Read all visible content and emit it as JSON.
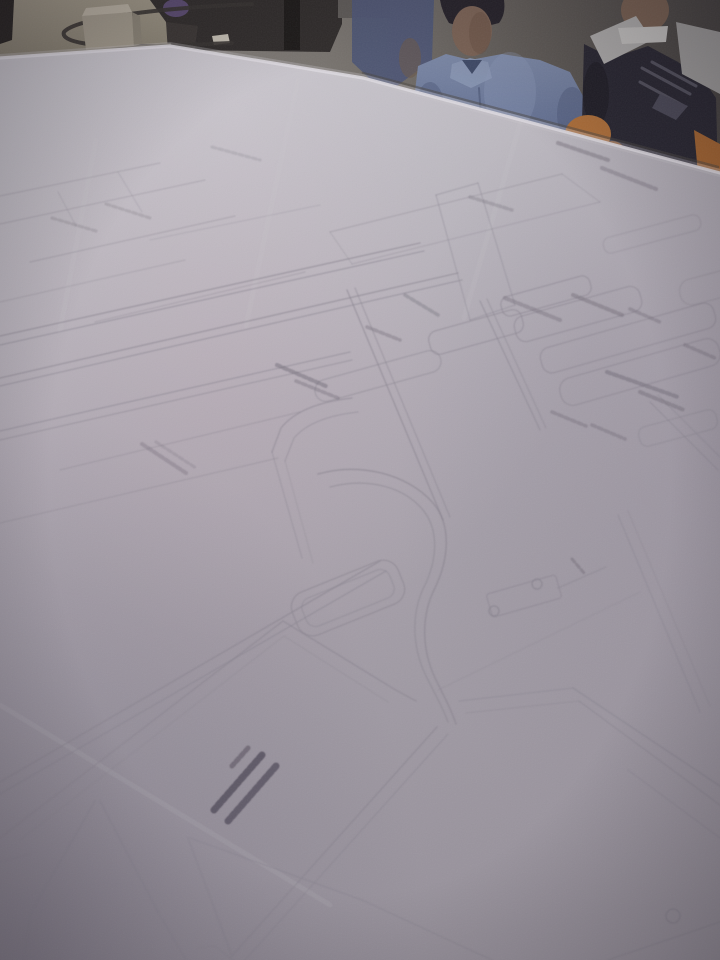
{
  "scene": {
    "description": "Photograph of large garment pattern drafting sheets covering a cutting table, viewed at an angle; two people stand behind the table, a cable and tissue box sit on a smaller table at top left",
    "palette": {
      "paper_light": "#c8c5ca",
      "paper_dark": "#9b959d",
      "pattern_line": "#8b8690",
      "annotation_ink": "#6f6974",
      "bold_ink": "#4e4854",
      "table_tan": "#a29a87",
      "shirt_blue": "#7e8ba8",
      "uniform_dark": "#27252e",
      "chair_orange": "#b06f36"
    },
    "background": [
      {
        "t": "rect",
        "x": 0,
        "y": 0,
        "w": 720,
        "h": 210,
        "f": "url(#wallGrad)",
        "n": "room-wall"
      },
      {
        "t": "poly",
        "p": "0,0 212,0 196,24 186,54 0,68",
        "f": "url(#tanGrad)",
        "n": "side-table-top"
      },
      {
        "t": "poly",
        "p": "0,0 14,0 12,40 0,44",
        "f": "#27231f",
        "n": "door-edge"
      },
      {
        "t": "poly",
        "p": "150,0 342,0 342,24 330,52 176,50 166,22",
        "f": "#2f2b28",
        "n": "dark-furniture"
      },
      {
        "t": "rect",
        "x": 284,
        "y": 0,
        "w": 16,
        "h": 50,
        "f": "#1b1815",
        "n": "furniture-leg"
      },
      {
        "t": "poly",
        "p": "166,22 198,26 194,54 168,52",
        "f": "#3a3531",
        "n": "table-gap-shadow"
      },
      {
        "t": "ell",
        "cx": 176,
        "cy": 8,
        "rx": 13,
        "ry": 9,
        "f": "#5b4b70",
        "n": "purple-object"
      },
      {
        "t": "rect",
        "x": 338,
        "y": 0,
        "w": 52,
        "h": 18,
        "f": "#5e5a55",
        "n": "shelf-object"
      },
      {
        "t": "poly",
        "p": "212,36 228,34 230,43 214,45",
        "f": "#c7c1b3",
        "n": "paper-scrap"
      },
      {
        "t": "ell",
        "cx": 110,
        "cy": 53,
        "rx": 33,
        "ry": 6,
        "f": "#6f6959",
        "o": 0.55,
        "n": "box-shadow"
      },
      {
        "t": "path",
        "d": "M252,4 C160,8 76,18 64,32 C60,42 92,48 158,46 L232,43",
        "s": "#36322d",
        "w": 4,
        "f": "none",
        "o": 0.9,
        "n": "power-cable"
      },
      {
        "t": "poly",
        "p": "82,16 132,12 134,46 86,50",
        "f": "#a59d8c",
        "n": "tissue-box-front"
      },
      {
        "t": "poly",
        "p": "82,16 132,12 128,4 86,8",
        "f": "#bdb5a4",
        "n": "tissue-box-top"
      },
      {
        "t": "poly",
        "p": "132,12 140,16 142,44 134,46",
        "f": "#8d8676",
        "n": "tissue-box-side"
      }
    ],
    "people": [
      {
        "t": "poly",
        "p": "352,0 434,0 432,60 386,94 352,62",
        "f": "#4e5674",
        "o": 0.95,
        "n": "person-left-shoulder"
      },
      {
        "t": "ell",
        "cx": 410,
        "cy": 58,
        "rx": 11,
        "ry": 20,
        "f": "#6b584a",
        "o": 0.6,
        "n": "person-left-arm"
      },
      {
        "t": "path",
        "d": "M440,0 L504,0 Q506,14 499,23 Q471,31 449,23 Q442,12 440,0 Z",
        "f": "#242026",
        "n": "person-blue-hair"
      },
      {
        "t": "ell",
        "cx": 472,
        "cy": 31,
        "rx": 20,
        "ry": 25,
        "f": "#7c6353",
        "n": "person-blue-face"
      },
      {
        "t": "ell",
        "cx": 480,
        "cy": 33,
        "rx": 11,
        "ry": 21,
        "f": "#6b5344",
        "o": 0.55,
        "n": "face-shadow"
      },
      {
        "t": "poly",
        "p": "414,100 418,66 446,54 470,60 502,54 540,60 570,72 584,98 588,142 540,152 468,154 424,152",
        "f": "url(#shirtGrad)",
        "n": "person-blue-shirt"
      },
      {
        "t": "poly",
        "p": "452,64 470,58 488,62 492,78 471,88 450,78",
        "f": "#8b98b4",
        "o": 0.9,
        "n": "shirt-collar"
      },
      {
        "t": "poly",
        "p": "462,60 482,60 472,74",
        "f": "#3f4a66",
        "n": "collar-opening"
      },
      {
        "t": "line",
        "x1": 479,
        "y1": 88,
        "x2": 483,
        "y2": 150,
        "s": "#4f5a78",
        "w": 2,
        "o": 0.7,
        "n": "shirt-placket"
      },
      {
        "t": "ell",
        "cx": 430,
        "cy": 112,
        "rx": 15,
        "ry": 30,
        "f": "#4d5878",
        "o": 0.45,
        "n": "sleeve-shadow-left"
      },
      {
        "t": "ell",
        "cx": 572,
        "cy": 114,
        "rx": 15,
        "ry": 27,
        "f": "#4d5878",
        "o": 0.45,
        "n": "sleeve-shadow-right"
      },
      {
        "t": "ell",
        "cx": 510,
        "cy": 92,
        "rx": 26,
        "ry": 40,
        "f": "#93a0bc",
        "o": 0.3,
        "n": "shirt-highlight"
      },
      {
        "t": "ell",
        "cx": 645,
        "cy": 10,
        "rx": 24,
        "ry": 22,
        "f": "#7b6250",
        "n": "person-dark-face"
      },
      {
        "t": "poly",
        "p": "584,44 612,58 648,46 678,62 702,78 716,98 718,180 598,184 582,122",
        "f": "#27252e",
        "n": "person-dark-shirt"
      },
      {
        "t": "poly",
        "p": "590,36 636,16 652,40 604,64",
        "f": "#b2b0ad",
        "n": "vest-panel-left"
      },
      {
        "t": "poly",
        "p": "676,22 720,32 720,94 682,74",
        "f": "#a3a19e",
        "n": "vest-panel-right"
      },
      {
        "t": "poly",
        "p": "618,28 668,26 666,42 622,44",
        "f": "#c9c7c3",
        "n": "undershirt-collar"
      },
      {
        "t": "path",
        "d": "M642,68 L690,94 M652,62 L696,86 M640,82 L684,106",
        "s": "#787683",
        "w": 3,
        "o": 0.55,
        "f": "none",
        "n": "vest-straps"
      },
      {
        "t": "poly",
        "p": "660,94 688,106 676,120 652,108",
        "f": "#4b4956",
        "n": "chest-pocket"
      },
      {
        "t": "ell",
        "cx": 596,
        "cy": 94,
        "rx": 13,
        "ry": 32,
        "f": "#1f1d24",
        "o": 0.9,
        "n": "person-dark-arm"
      },
      {
        "t": "ell",
        "cx": 588,
        "cy": 134,
        "rx": 23,
        "ry": 19,
        "f": "#b06f36",
        "n": "chair-back"
      },
      {
        "t": "ell",
        "cx": 612,
        "cy": 152,
        "rx": 13,
        "ry": 11,
        "f": "#9c5e2c",
        "o": 0.9,
        "n": "chair-back-small"
      },
      {
        "t": "poly",
        "p": "694,130 720,144 720,182 698,174",
        "f": "#a8662e",
        "n": "chair-back-right"
      }
    ],
    "paper": {
      "outline": "0,58 170,46 363,78 720,173 720,960 0,960",
      "edges": [
        {
          "p": "0,56 170,44",
          "s": "#8a8374",
          "w": 2,
          "o": 0.6,
          "n": "paper-edge-left"
        },
        {
          "p": "363,73 718,167",
          "s": "#4a4540",
          "w": 2.5,
          "o": 0.5,
          "n": "table-edge-shadow"
        },
        {
          "p": "0,58 170,46 363,78 720,173",
          "s": "#cfccd2",
          "w": 8,
          "o": 0.3,
          "n": "paper-edge-glow"
        },
        {
          "p": "0,58 170,46 363,78 720,173",
          "s": "#e3e0e4",
          "w": 3.2,
          "o": 0.9,
          "n": "paper-edge-highlight"
        }
      ]
    }
  },
  "pattern_drawing": {
    "line_color": "#8b8690",
    "crease_color": "#d8d5da",
    "annotation_color": "#6f6974",
    "lines": [
      [
        0,
        196,
        160,
        163,
        1.2,
        0.28
      ],
      [
        0,
        224,
        205,
        180,
        1.2,
        0.28
      ],
      [
        30,
        262,
        235,
        216,
        1.2,
        0.3
      ],
      [
        0,
        302,
        185,
        260,
        1.2,
        0.25
      ],
      [
        95,
        322,
        305,
        272,
        1.2,
        0.28
      ],
      [
        118,
        172,
        142,
        212,
        1.1,
        0.22
      ],
      [
        58,
        192,
        76,
        226,
        1.1,
        0.22
      ],
      [
        150,
        240,
        320,
        205,
        1.1,
        0.22
      ],
      [
        0,
        336,
        420,
        243,
        1.4,
        0.5
      ],
      [
        0,
        345,
        424,
        251,
        1.3,
        0.45
      ],
      [
        0,
        378,
        458,
        273,
        1.4,
        0.5
      ],
      [
        0,
        386,
        462,
        280,
        1.3,
        0.45
      ],
      [
        0,
        431,
        350,
        352,
        1.3,
        0.45
      ],
      [
        0,
        440,
        352,
        360,
        1.2,
        0.4
      ],
      [
        60,
        470,
        300,
        412,
        1.2,
        0.3
      ],
      [
        0,
        523,
        278,
        458,
        1.2,
        0.3
      ],
      [
        347,
        290,
        443,
        520,
        1.4,
        0.5
      ],
      [
        355,
        288,
        450,
        517,
        1.2,
        0.4
      ],
      [
        480,
        301,
        540,
        430,
        1.3,
        0.45
      ],
      [
        487,
        299,
        546,
        428,
        1.2,
        0.38
      ],
      [
        330,
        232,
        562,
        174,
        1.2,
        0.3
      ],
      [
        352,
        264,
        600,
        202,
        1.2,
        0.28
      ],
      [
        330,
        232,
        352,
        264,
        1.1,
        0.25
      ],
      [
        562,
        174,
        600,
        202,
        1.1,
        0.25
      ],
      [
        436,
        195,
        478,
        183,
        1.2,
        0.35
      ],
      [
        436,
        195,
        470,
        320,
        1.2,
        0.35
      ],
      [
        478,
        183,
        515,
        305,
        1.2,
        0.35
      ],
      [
        470,
        320,
        515,
        305,
        1.2,
        0.35
      ],
      [
        558,
        588,
        606,
        567,
        1.3,
        0.4
      ],
      [
        0,
        782,
        380,
        561,
        1.5,
        0.5
      ],
      [
        0,
        794,
        386,
        571,
        1.3,
        0.45
      ],
      [
        272,
        452,
        302,
        558,
        1.3,
        0.32
      ],
      [
        285,
        461,
        313,
        563,
        1.1,
        0.25
      ],
      [
        618,
        515,
        700,
        712,
        1.3,
        0.35
      ],
      [
        628,
        511,
        710,
        706,
        1.1,
        0.28
      ],
      [
        650,
        402,
        718,
        470,
        1.3,
        0.4
      ],
      [
        658,
        395,
        720,
        457,
        1.2,
        0.35
      ],
      [
        573,
        688,
        720,
        786,
        1.4,
        0.48
      ],
      [
        579,
        701,
        720,
        805,
        1.3,
        0.42
      ],
      [
        628,
        770,
        720,
        838,
        1.2,
        0.32
      ],
      [
        459,
        701,
        573,
        688,
        1.2,
        0.35
      ],
      [
        466,
        713,
        579,
        701,
        1.1,
        0.3
      ],
      [
        230,
        958,
        437,
        727,
        1.5,
        0.5
      ],
      [
        245,
        960,
        448,
        734,
        1.3,
        0.4
      ],
      [
        95,
        801,
        30,
        914,
        1.4,
        0.48
      ],
      [
        30,
        914,
        24,
        960,
        1.3,
        0.42
      ],
      [
        100,
        801,
        158,
        912,
        1.4,
        0.48
      ],
      [
        158,
        912,
        186,
        960,
        1.3,
        0.4
      ],
      [
        0,
        862,
        30,
        854,
        1.1,
        0.28
      ],
      [
        188,
        838,
        232,
        956,
        1.4,
        0.45
      ],
      [
        190,
        838,
        362,
        900,
        1.4,
        0.45
      ],
      [
        362,
        900,
        492,
        960,
        1.3,
        0.4
      ],
      [
        215,
        946,
        233,
        960,
        1.1,
        0.35
      ],
      [
        197,
        948,
        215,
        946,
        1.1,
        0.3
      ],
      [
        608,
        960,
        720,
        922,
        1.3,
        0.42
      ],
      [
        438,
        690,
        640,
        592,
        1.1,
        0.2
      ]
    ],
    "light_lines": [
      [
        298,
        80,
        246,
        326
      ],
      [
        520,
        124,
        464,
        318
      ],
      [
        96,
        140,
        60,
        330
      ],
      [
        0,
        705,
        330,
        905
      ]
    ],
    "paths": [
      {
        "d": "M318,474 C360,462 408,474 433,503 C452,525 449,560 434,590 C421,617 421,652 438,684 C446,700 452,712 456,724",
        "w": 1.6,
        "o": 0.5
      },
      {
        "d": "M330,487 C368,477 404,487 423,510 C440,531 437,562 423,589 C411,615 412,650 428,680 C436,696 443,708 448,722",
        "w": 1.4,
        "o": 0.42
      },
      {
        "d": "M352,398 Q300,404 281,428 L272,452",
        "w": 1.4,
        "o": 0.45
      },
      {
        "d": "M358,412 Q312,417 294,438 L285,461",
        "w": 1.2,
        "o": 0.38
      },
      {
        "d": "M0,838 L283,621 L394,689 L416,701",
        "w": 1.5,
        "o": 0.48
      },
      {
        "d": "M20,840 L284,636 L388,702",
        "w": 1.1,
        "o": 0.25
      }
    ],
    "pieces": [
      [
        546,
        296,
        92,
        20,
        8,
        -15.5,
        0.45
      ],
      [
        578,
        314,
        130,
        26,
        10,
        -15.5,
        0.45
      ],
      [
        628,
        338,
        180,
        26,
        10,
        -16,
        0.45
      ],
      [
        640,
        372,
        165,
        28,
        12,
        -16,
        0.45
      ],
      [
        678,
        428,
        80,
        20,
        8,
        -15,
        0.4
      ],
      [
        476,
        332,
        96,
        24,
        9,
        -15.5,
        0.45
      ],
      [
        378,
        376,
        130,
        22,
        11,
        -15.5,
        0.4
      ],
      [
        652,
        234,
        100,
        16,
        7,
        -15,
        0.28
      ],
      [
        714,
        286,
        70,
        26,
        12,
        -15,
        0.3
      ],
      [
        524,
        596,
        72,
        24,
        3,
        -16,
        0.45
      ],
      [
        348,
        598,
        114,
        46,
        16,
        -22,
        0.5
      ],
      [
        348,
        598,
        94,
        30,
        10,
        -22,
        0.4
      ]
    ],
    "circles": [
      [
        494,
        611,
        5
      ],
      [
        537,
        584,
        5
      ],
      [
        673,
        916,
        7
      ]
    ],
    "annotations": [
      [
        558,
        143,
        608,
        160,
        4,
        0.4
      ],
      [
        602,
        168,
        656,
        189,
        4,
        0.35
      ],
      [
        470,
        197,
        512,
        210,
        3.5,
        0.28
      ],
      [
        405,
        295,
        438,
        315,
        3.5,
        0.32
      ],
      [
        505,
        298,
        560,
        320,
        4,
        0.35
      ],
      [
        573,
        295,
        622,
        315,
        4,
        0.4
      ],
      [
        630,
        309,
        660,
        322,
        3.5,
        0.35
      ],
      [
        685,
        345,
        715,
        358,
        3.5,
        0.35
      ],
      [
        277,
        365,
        328,
        387,
        4,
        0.45
      ],
      [
        296,
        381,
        338,
        398,
        3.5,
        0.35
      ],
      [
        367,
        327,
        400,
        340,
        3.5,
        0.35
      ],
      [
        607,
        372,
        678,
        397,
        4,
        0.45
      ],
      [
        640,
        392,
        684,
        410,
        4,
        0.4
      ],
      [
        552,
        412,
        586,
        426,
        3.5,
        0.35
      ],
      [
        592,
        425,
        625,
        439,
        3.5,
        0.35
      ],
      [
        142,
        444,
        186,
        473,
        4,
        0.3
      ],
      [
        156,
        442,
        196,
        468,
        3,
        0.2
      ],
      [
        572,
        559,
        584,
        573,
        3,
        0.4
      ],
      [
        52,
        218,
        96,
        231,
        3,
        0.22
      ],
      [
        106,
        204,
        150,
        218,
        3,
        0.22
      ],
      [
        212,
        147,
        260,
        160,
        3,
        0.18
      ],
      [
        262,
        755,
        214,
        810,
        7,
        0.75,
        "#4e4854"
      ],
      [
        276,
        766,
        228,
        821,
        7,
        0.7,
        "#4e4854"
      ],
      [
        248,
        748,
        232,
        766,
        5,
        0.5,
        "#4e4854"
      ]
    ]
  }
}
